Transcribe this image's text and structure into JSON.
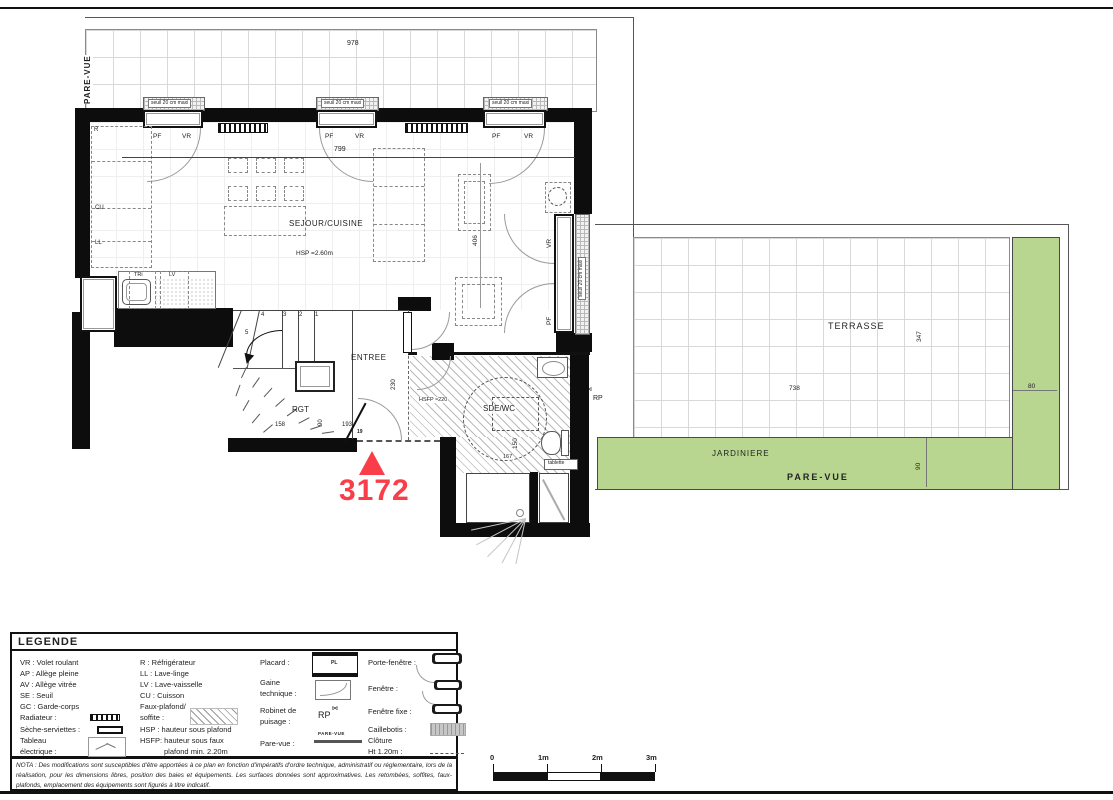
{
  "colors": {
    "green": "#b8d690",
    "red": "#f93e4a"
  },
  "plan": {
    "unit_number": "3172",
    "labels": {
      "pare_vue": "PARE-VUE",
      "sejour": "SEJOUR/CUISINE",
      "hsp": "HSP =2.60m",
      "entree": "ENTREE",
      "rgt": "RGT",
      "sde_wc": "SDE/WC",
      "hsfp": "HSFP ≈220",
      "tablette": "tablette",
      "rp": "RP",
      "terrasse": "TERRASSE",
      "jardiniere": "JARDINIERE",
      "pare_vue_bottom": "PARE-VUE",
      "seuil": "seuil 20 cm maxi",
      "pf": "PF",
      "vr": "VR",
      "r": "R",
      "cu": "CU",
      "ll": "LL",
      "tri": "TRi",
      "lv": "LV"
    },
    "dims": {
      "d978": "978",
      "d799": "799",
      "d406": "406",
      "d230": "230",
      "d158": "158",
      "d90": "90",
      "d193": "193",
      "d19": "19",
      "d150": "150",
      "d167": "167",
      "d347": "347",
      "d738": "738",
      "d80": "80",
      "d90b": "90"
    },
    "stairs": [
      "1",
      "2",
      "3",
      "4",
      "5"
    ]
  },
  "legend": {
    "title": "LEGENDE",
    "col1": [
      "VR : Volet roulant",
      "AP : Allège pleine",
      "AV : Allège vitrée",
      "SE : Seuil",
      "GC : Garde-corps",
      "Radiateur :",
      "Sèche-serviettes :",
      "Tableau",
      "électrique :"
    ],
    "col2": [
      "R : Réfrigérateur",
      "LL : Lave-linge",
      "LV : Lave-vaisselle",
      "CU : Cuisson",
      "Faux-plafond/",
      "soffite :",
      "HSP : hauteur sous plafond",
      "HSFP: hauteur sous faux",
      "plafond min. 2.20m"
    ],
    "col3": [
      "Placard :",
      "PL",
      "Gaine",
      "technique :",
      "Robinet de",
      "puisage :",
      "RP",
      "Pare-vue :",
      "PARE-VUE"
    ],
    "col4": [
      "Porte-fenêtre :",
      "Fenêtre :",
      "Fenêtre fixe :",
      "Caillebotis :",
      "Clôture",
      "Ht 1.20m :"
    ]
  },
  "nota": "NOTA : Des modifications sont susceptibles d'être apportées à ce plan en fonction d'impératifs d'ordre technique, administratif ou réglementaire, lors de la réalisation, pour les dimensions libres, position des baies et équipements. Les surfaces données sont approximatives. Les retombées, soffites, faux-plafonds, emplacement des équipements sont figurés à titre indicatif.",
  "scale_bar": {
    "t0": "0",
    "t1": "1m",
    "t2": "2m",
    "t3": "3m"
  }
}
